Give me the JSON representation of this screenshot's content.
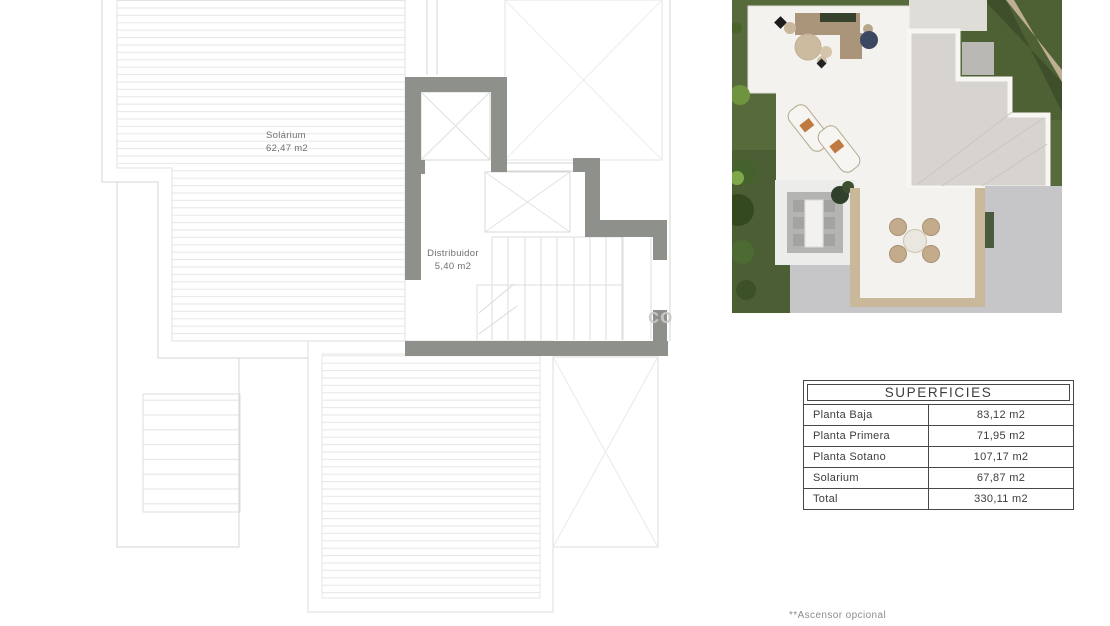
{
  "plan": {
    "solarium": {
      "name": "Solárium",
      "area": "62,47 m2"
    },
    "distribuidor": {
      "name": "Distribuidor",
      "area": "5,40 m2"
    },
    "watermark": "co"
  },
  "table": {
    "title": "SUPERFICIES",
    "rows": [
      {
        "label": "Planta Baja",
        "value": "83,12 m2"
      },
      {
        "label": "Planta Primera",
        "value": "71,95 m2"
      },
      {
        "label": "Planta Sotano",
        "value": "107,17 m2"
      },
      {
        "label": "Solarium",
        "value": "67,87 m2"
      },
      {
        "label": "Total",
        "value": "330,11 m2"
      }
    ]
  },
  "footnote": {
    "text": "**Ascensor opcional"
  },
  "colors": {
    "wall_grey": "#8e908c",
    "plan_line": "#d5d5d5",
    "deck_stripe": "#e7e7e7",
    "table_border": "#474747",
    "grass_green": "#566a3c",
    "hedge_green": "#3f4f2c",
    "terrace_white": "#f3f2ef",
    "roof_tile_grey": "#d7d4d0",
    "gravel_tan": "#c9b89a",
    "label_grey": "#6f6f6f"
  }
}
